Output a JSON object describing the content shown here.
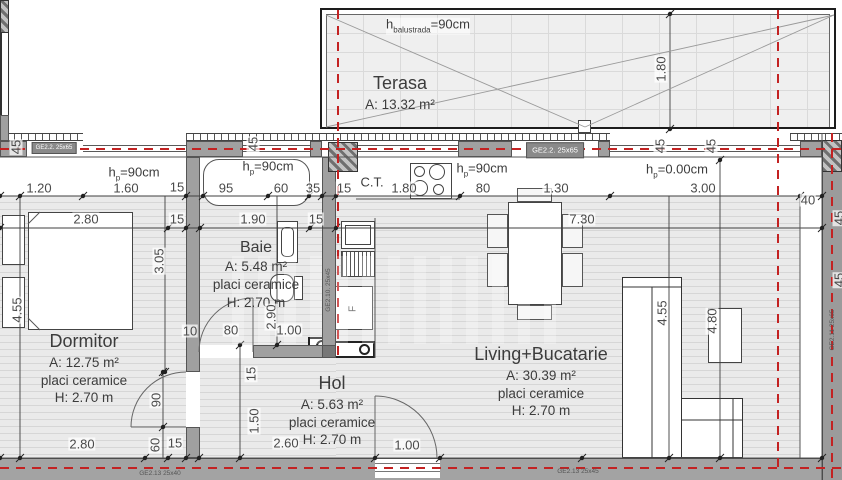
{
  "rooms": {
    "terasa": {
      "name": "Terasa",
      "area": "A: 13.32 m²"
    },
    "dormitor": {
      "name": "Dormitor",
      "area": "A: 12.75 m²",
      "floor": "placi ceramice",
      "height": "H: 2.70 m"
    },
    "baie": {
      "name": "Baie",
      "area": "A: 5.48 m²",
      "floor": "placi ceramice",
      "height": "H: 2.70 m"
    },
    "hol": {
      "name": "Hol",
      "area": "A: 5.63 m²",
      "floor": "placi ceramice",
      "height": "H: 2.70 m"
    },
    "living": {
      "name": "Living+Bucatarie",
      "area": "A: 30.39 m²",
      "floor": "placi ceramice",
      "height": "H: 2.70 m"
    }
  },
  "fixtures": {
    "boiler": "C.T.",
    "fridge": "F"
  },
  "parapets": [
    {
      "pre": "h",
      "sub": "balustrada",
      "post": "=90cm",
      "x": 428,
      "y": 26
    },
    {
      "pre": "h",
      "sub": "p",
      "post": "=90cm",
      "x": 134,
      "y": 174
    },
    {
      "pre": "h",
      "sub": "p",
      "post": "=90cm",
      "x": 268,
      "y": 168
    },
    {
      "pre": "h",
      "sub": "p",
      "post": "=90cm",
      "x": 482,
      "y": 170
    },
    {
      "pre": "h",
      "sub": "p",
      "post": "=0.00cm",
      "x": 677,
      "y": 171
    }
  ],
  "wall_tags": [
    {
      "t": "GE2.2. 25x65",
      "x": 54,
      "y": 148,
      "cls": "gbox gbox-sm"
    },
    {
      "t": "GE2.2. 25x65",
      "x": 555,
      "y": 150,
      "cls": "gbox"
    },
    {
      "t": "GE2.10. 25x45",
      "x": 329,
      "y": 290,
      "r": 1,
      "cls": "gdark"
    },
    {
      "t": "GE2.11 25x65",
      "x": 833,
      "y": 330,
      "r": 1,
      "cls": "gdark"
    },
    {
      "t": "GE2.13 25x40",
      "x": 160,
      "y": 474,
      "cls": "gdark"
    },
    {
      "t": "GE2.13 25x45",
      "x": 578,
      "y": 472,
      "cls": "gdark"
    }
  ],
  "dims": [
    {
      "t": "1.20",
      "x": 39,
      "y": 188
    },
    {
      "t": "1.60",
      "x": 126,
      "y": 188
    },
    {
      "t": "15",
      "x": 177,
      "y": 187
    },
    {
      "t": "95",
      "x": 226,
      "y": 188
    },
    {
      "t": "60",
      "x": 281,
      "y": 188
    },
    {
      "t": "35",
      "x": 313,
      "y": 188
    },
    {
      "t": "15",
      "x": 344,
      "y": 188
    },
    {
      "t": "1.80",
      "x": 404,
      "y": 188
    },
    {
      "t": "80",
      "x": 483,
      "y": 188
    },
    {
      "t": "1.30",
      "x": 556,
      "y": 188
    },
    {
      "t": "3.00",
      "x": 703,
      "y": 188
    },
    {
      "t": "40",
      "x": 808,
      "y": 200
    },
    {
      "t": "2.80",
      "x": 86,
      "y": 219
    },
    {
      "t": "15",
      "x": 177,
      "y": 219
    },
    {
      "t": "1.90",
      "x": 253,
      "y": 219
    },
    {
      "t": "15",
      "x": 316,
      "y": 219
    },
    {
      "t": "7.30",
      "x": 582,
      "y": 219
    },
    {
      "t": "10",
      "x": 190,
      "y": 331
    },
    {
      "t": "80",
      "x": 231,
      "y": 330
    },
    {
      "t": "1.00",
      "x": 289,
      "y": 330
    },
    {
      "t": "2.80",
      "x": 82,
      "y": 444
    },
    {
      "t": "15",
      "x": 175,
      "y": 443
    },
    {
      "t": "2.60",
      "x": 286,
      "y": 443
    },
    {
      "t": "1.00",
      "x": 407,
      "y": 445
    },
    {
      "t": "45",
      "x": 16,
      "y": 147,
      "r": 1
    },
    {
      "t": "45",
      "x": 253,
      "y": 144,
      "r": 1
    },
    {
      "t": "45",
      "x": 660,
      "y": 146,
      "r": 1
    },
    {
      "t": "45",
      "x": 711,
      "y": 146,
      "r": 1
    },
    {
      "t": "1.80",
      "x": 661,
      "y": 69,
      "r": 1
    },
    {
      "t": "3.05",
      "x": 159,
      "y": 261,
      "r": 1
    },
    {
      "t": "4.55",
      "x": 17,
      "y": 310,
      "r": 1
    },
    {
      "t": "2.90",
      "x": 271,
      "y": 317,
      "r": 1
    },
    {
      "t": "90",
      "x": 156,
      "y": 400,
      "r": 1
    },
    {
      "t": "60",
      "x": 155,
      "y": 445,
      "r": 1
    },
    {
      "t": "15",
      "x": 251,
      "y": 374,
      "r": 1
    },
    {
      "t": "1.50",
      "x": 254,
      "y": 421,
      "r": 1
    },
    {
      "t": "4.55",
      "x": 662,
      "y": 313,
      "r": 1
    },
    {
      "t": "4.80",
      "x": 712,
      "y": 321,
      "r": 1
    },
    {
      "t": "45",
      "x": 839,
      "y": 218,
      "r": 1
    },
    {
      "t": "45",
      "x": 839,
      "y": 280,
      "r": 1
    }
  ]
}
